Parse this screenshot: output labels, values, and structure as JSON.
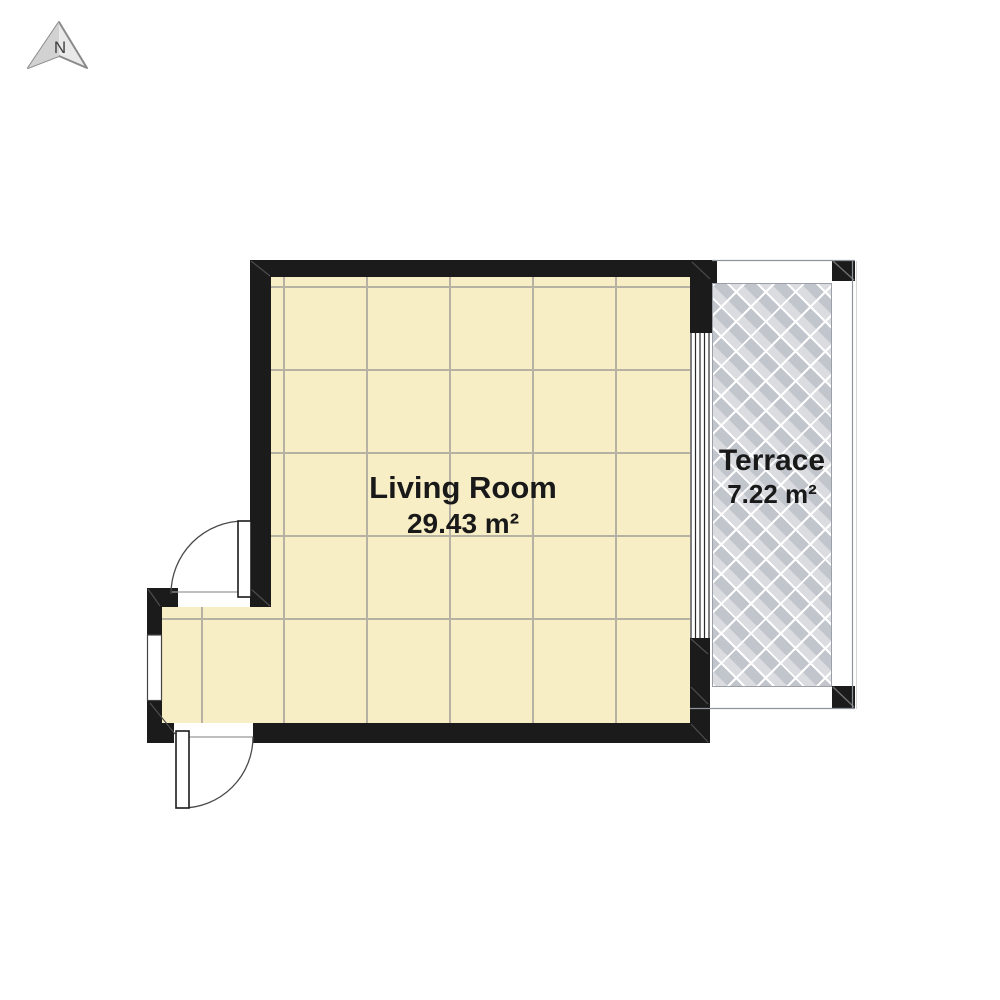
{
  "compass": {
    "label": "N"
  },
  "rooms": {
    "living_room": {
      "name": "Living Room",
      "area": "29.43 m²"
    },
    "terrace": {
      "name": "Terrace",
      "area": "7.22 m²"
    }
  },
  "colors": {
    "background": "#ffffff",
    "wall": "#1b1b1b",
    "living_room_floor": "#f8eec5",
    "floor_grid_line": "#b6b1a2",
    "terrace_floor": "#cfd2d8",
    "terrace_pattern_line": "#ffffff",
    "terrace_outline": "#8f949c",
    "door_arc": "#4a4a4a",
    "label_text": "#191919"
  }
}
